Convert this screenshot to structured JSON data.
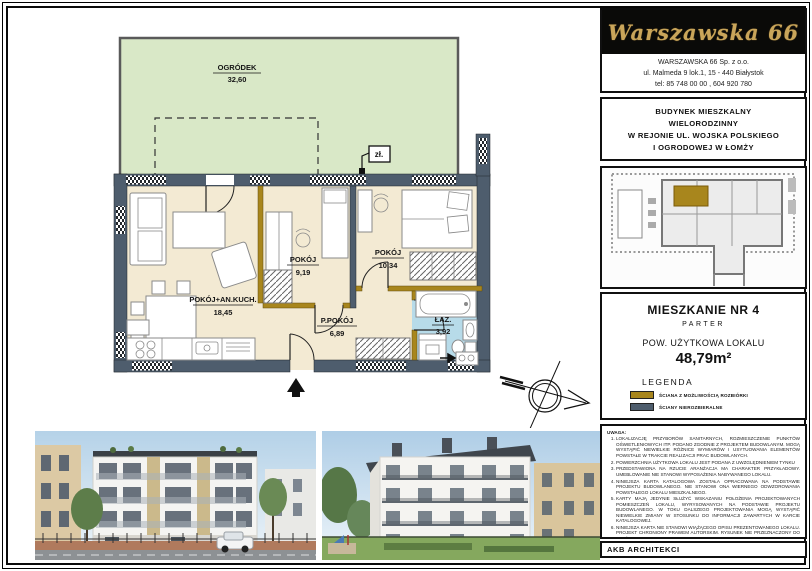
{
  "brand": {
    "name": "Warszawska 66"
  },
  "company": {
    "name": "WARSZAWSKA  66   Sp.  z o.o.",
    "address": "ul. Malmeda 9  lok.1,   15 - 440 Białystok",
    "phone": "tel: 85 748 00 00 ,  604 920 780"
  },
  "project": {
    "line1": "BUDYNEK  MIESZKALNY",
    "line2": "WIELORODZINNY",
    "line3": "W  REJONIE  UL. WOJSKA  POLSKIEGO",
    "line4": "I  OGRODOWEJ   W  ŁOMŻY"
  },
  "apartment": {
    "title": "MIESZKANIE NR 4",
    "floor": "PARTER",
    "area_label": "POW. UŻYTKOWA LOKALU",
    "area_value": "48,79m²"
  },
  "legend": {
    "title": "LEGENDA",
    "item1": "ŚCIANA Z MOŻLIWOŚCIĄ ROZBIÓRKI",
    "item2": "ŚCIANY NIEROZBIERALNE",
    "color1": "#a8861d",
    "color2": "#4e5d6d"
  },
  "notes": {
    "title": "UWAGA:",
    "items": [
      "LOKALIZACJĘ PRZYBORÓW SANITARNYCH, ROZMIESZCZENIE PUNKTÓW OŚWIETLENIOWYCH ITP. PODANO ZGODNIE Z PROJEKTEM BUDOWLANYM. MOGĄ WYSTĄPIĆ NIEWIELKIE RÓŻNICE WYMIARÓW I USYTUOWANIA ELEMENTÓW POWSTAŁE W TRAKCIE REALIZACJI PRAC BUDOWLANYCH.",
      "POWIERZCHNIA UŻYTKOWA LOKALU JEST PODANA Z UWZGLĘDNIENIEM TYNKU",
      "PRZEDSTAWIONA NA RZUCIE ARANŻACJA MA CHARAKTER PRZYKŁADOWY. UMEBLOWANIE NIE STANOWI WYPOSAŻENIA NABYWANEGO LOKALU.",
      "NINIEJSZA KARTA KATALOGOWA ZOSTAŁA OPRACOWANA NA PODSTAWIE PROJEKTU BUDOWLANEGO. NIE STANOWI ONA WIERNEGO ODWZOROWANIA POWSTAŁEGO LOKALU MIESZKALNEGO.",
      "KARTY MAJĄ JEDYNIE SŁUŻYĆ WSKAZANIU POŁOŻENIA PROJEKTOWANYCH POMIESZCZEŃ LOKALU, WYRYSOWANYCH NA PODSTAWIE PROJEKTU BUDOWLANEGO. W TOKU DALSZEGO PROJEKTOWANIA MOGĄ WYSTĄPIĆ NIEWIELKIE ZMIANY W STOSUNKU DO INFORMACJI ZAWARTYCH W KARCIE KATALOGOWEJ.",
      "NINIEJSZA KARTA NIE STANOWI WIĄŻĄCEGO OPISU PREZENTOWANEGO LOKALU. PROJEKT CHRONIONY PRAWEM AUTORSKIM. RYSUNEK NIE PRZEZNACZONY DO CELÓW WYKONAWCZYCH"
    ]
  },
  "footer": {
    "studio": "AKB  ARCHITEKCI"
  },
  "plan": {
    "garden": {
      "name": "OGRÓDEK",
      "area": "32,60"
    },
    "living": {
      "name": "POKÓJ+AN.KUCH.",
      "area": "18,45"
    },
    "room1": {
      "name": "POKÓJ",
      "area": "9,19"
    },
    "room2": {
      "name": "POKÓJ",
      "area": "10,34"
    },
    "hall": {
      "name": "P.POKÓJ",
      "area": "6,89"
    },
    "bath": {
      "name": "ŁAZ.",
      "area": "3,92"
    },
    "tap_label": "zł.",
    "colors": {
      "garden": "#d9e8c7",
      "floor": "#f3ead3",
      "bath_floor": "#b7dbe9",
      "wall_structural": "#4e5d6d",
      "wall_removable": "#a8861d"
    }
  }
}
